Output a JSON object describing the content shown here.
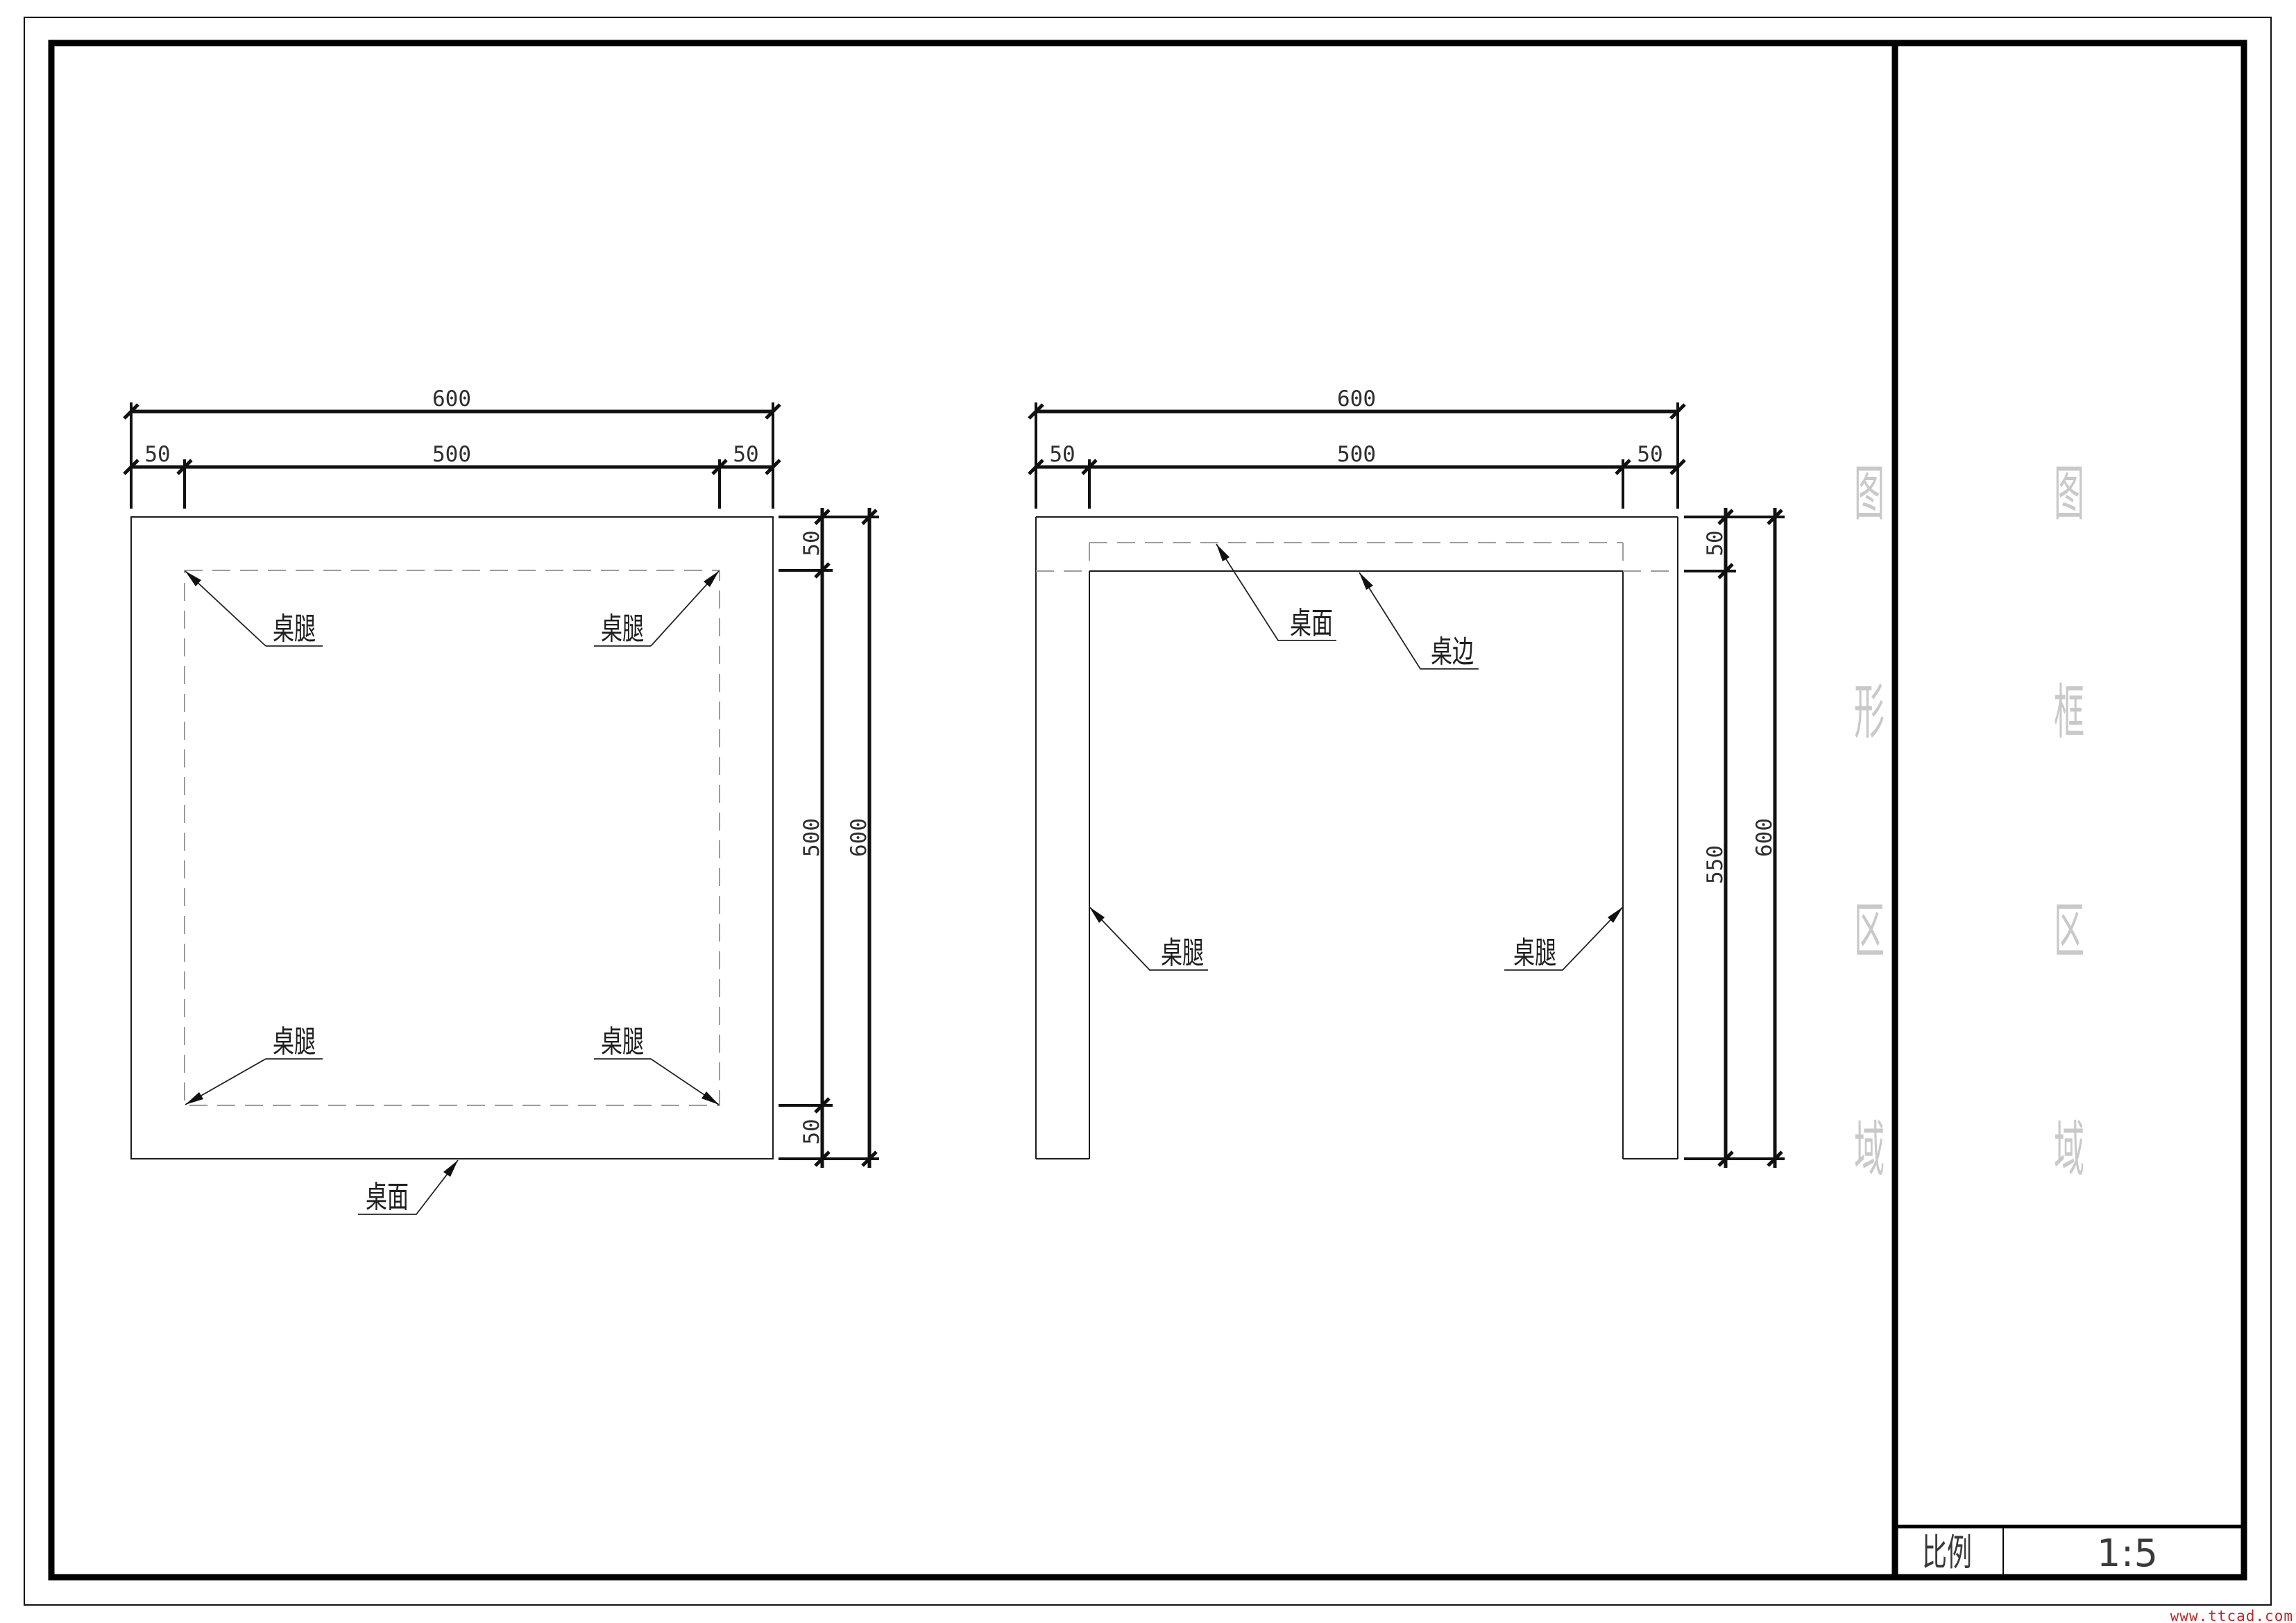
{
  "title_block": {
    "scale_label": "比例",
    "scale_value": "1:5"
  },
  "watermarks": {
    "drawing_area_column": [
      "图",
      "形",
      "区",
      "域"
    ],
    "frame_area_column": [
      "图",
      "框",
      "区",
      "域"
    ],
    "website": "www.ttcad.com"
  },
  "top_view": {
    "dim_total_width": "600",
    "dim_left_inset": "50",
    "dim_inner_width": "500",
    "dim_right_inset": "50",
    "dim_top_inset": "50",
    "dim_inner_height": "500",
    "dim_bottom_inset": "50",
    "dim_total_height": "600",
    "label_leg_tl": "桌腿",
    "label_leg_tr": "桌腿",
    "label_leg_bl": "桌腿",
    "label_leg_br": "桌腿",
    "label_tabletop": "桌面"
  },
  "front_view": {
    "dim_total_width": "600",
    "dim_left_leg": "50",
    "dim_inner_width": "500",
    "dim_right_leg": "50",
    "dim_top_thickness": "50",
    "dim_leg_height": "550",
    "dim_total_height": "600",
    "label_tabletop": "桌面",
    "label_edge": "桌边",
    "label_leg_left": "桌腿",
    "label_leg_right": "桌腿"
  }
}
